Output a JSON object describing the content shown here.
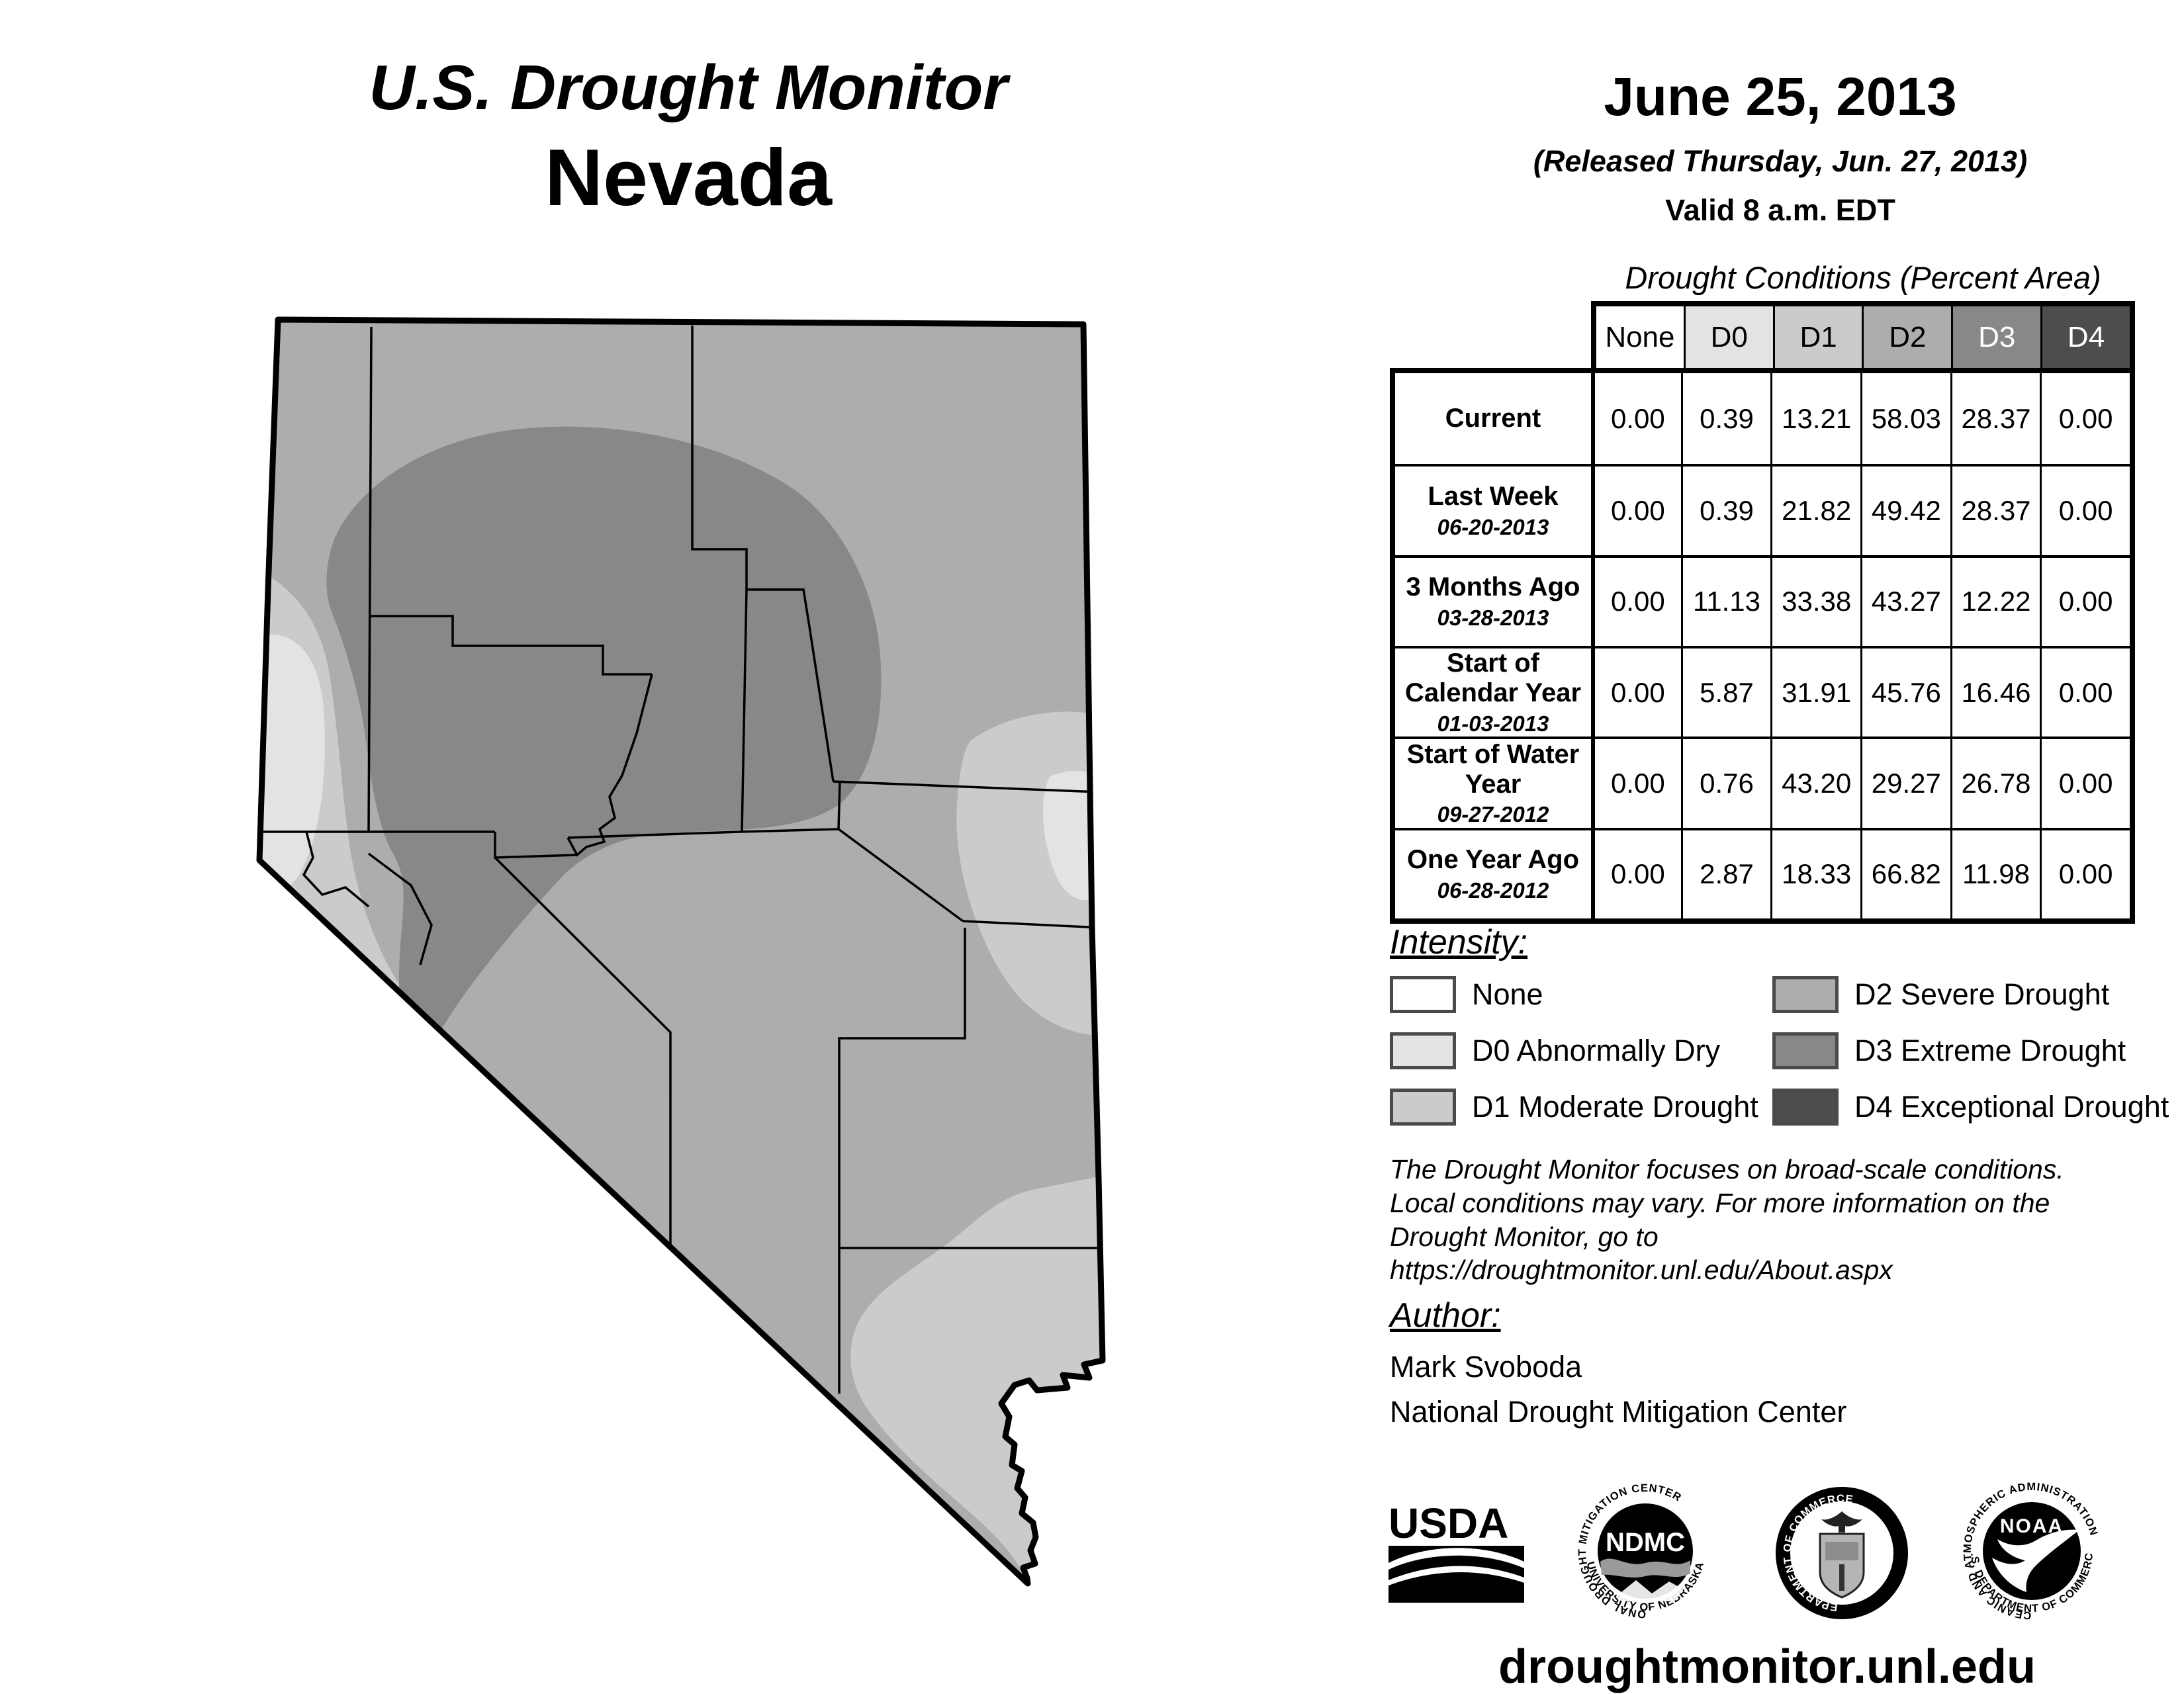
{
  "palette": {
    "none": "#ffffff",
    "d0": "#e3e3e3",
    "d1": "#cbcbcb",
    "d2": "#adadad",
    "d3": "#888888",
    "d4": "#4d4d4d",
    "border": "#000000"
  },
  "header": {
    "title": "U.S. Drought Monitor",
    "region": "Nevada",
    "date": "June 25, 2013",
    "released": "(Released Thursday, Jun. 27, 2013)",
    "valid": "Valid 8 a.m. EDT"
  },
  "table": {
    "title": "Drought Conditions (Percent Area)",
    "columns": [
      "None",
      "D0",
      "D1",
      "D2",
      "D3",
      "D4"
    ],
    "rows": [
      {
        "label": "Current",
        "date": "",
        "values": [
          "0.00",
          "0.39",
          "13.21",
          "58.03",
          "28.37",
          "0.00"
        ]
      },
      {
        "label": "Last Week",
        "date": "06-20-2013",
        "values": [
          "0.00",
          "0.39",
          "21.82",
          "49.42",
          "28.37",
          "0.00"
        ]
      },
      {
        "label": "3 Months Ago",
        "date": "03-28-2013",
        "values": [
          "0.00",
          "11.13",
          "33.38",
          "43.27",
          "12.22",
          "0.00"
        ]
      },
      {
        "label": "Start of Calendar Year",
        "date": "01-03-2013",
        "values": [
          "0.00",
          "5.87",
          "31.91",
          "45.76",
          "16.46",
          "0.00"
        ]
      },
      {
        "label": "Start of Water Year",
        "date": "09-27-2012",
        "values": [
          "0.00",
          "0.76",
          "43.20",
          "29.27",
          "26.78",
          "0.00"
        ]
      },
      {
        "label": "One Year Ago",
        "date": "06-28-2012",
        "values": [
          "0.00",
          "2.87",
          "18.33",
          "66.82",
          "11.98",
          "0.00"
        ]
      }
    ]
  },
  "legend": {
    "heading": "Intensity:",
    "items": [
      {
        "key": "none",
        "label": "None"
      },
      {
        "key": "d0",
        "label": "D0 Abnormally Dry"
      },
      {
        "key": "d1",
        "label": "D1 Moderate Drought"
      },
      {
        "key": "d2",
        "label": "D2 Severe Drought"
      },
      {
        "key": "d3",
        "label": "D3 Extreme Drought"
      },
      {
        "key": "d4",
        "label": "D4 Exceptional Drought"
      }
    ]
  },
  "disclaimer": "The Drought Monitor focuses on broad-scale conditions.\nLocal conditions may vary. For more information on the\nDrought Monitor, go to https://droughtmonitor.unl.edu/About.aspx",
  "author": {
    "heading": "Author:",
    "name": "Mark Svoboda",
    "org": "National Drought Mitigation Center"
  },
  "logos": {
    "usda": {
      "label": "USDA"
    },
    "ndmc": {
      "label": "NDMC",
      "top": "NATIONAL DROUGHT MITIGATION CENTER",
      "bottom": "UNIVERSITY OF NEBRASKA"
    },
    "doc": {
      "top": "DEPARTMENT OF COMMERCE",
      "bottom": "UNITED STATES OF AMERICA"
    },
    "noaa": {
      "label": "NOAA",
      "top": "NATIONAL OCEANIC AND ATMOSPHERIC ADMINISTRATION",
      "bottom": "U.S. DEPARTMENT OF COMMERCE"
    }
  },
  "footer": "droughtmonitor.unl.edu"
}
